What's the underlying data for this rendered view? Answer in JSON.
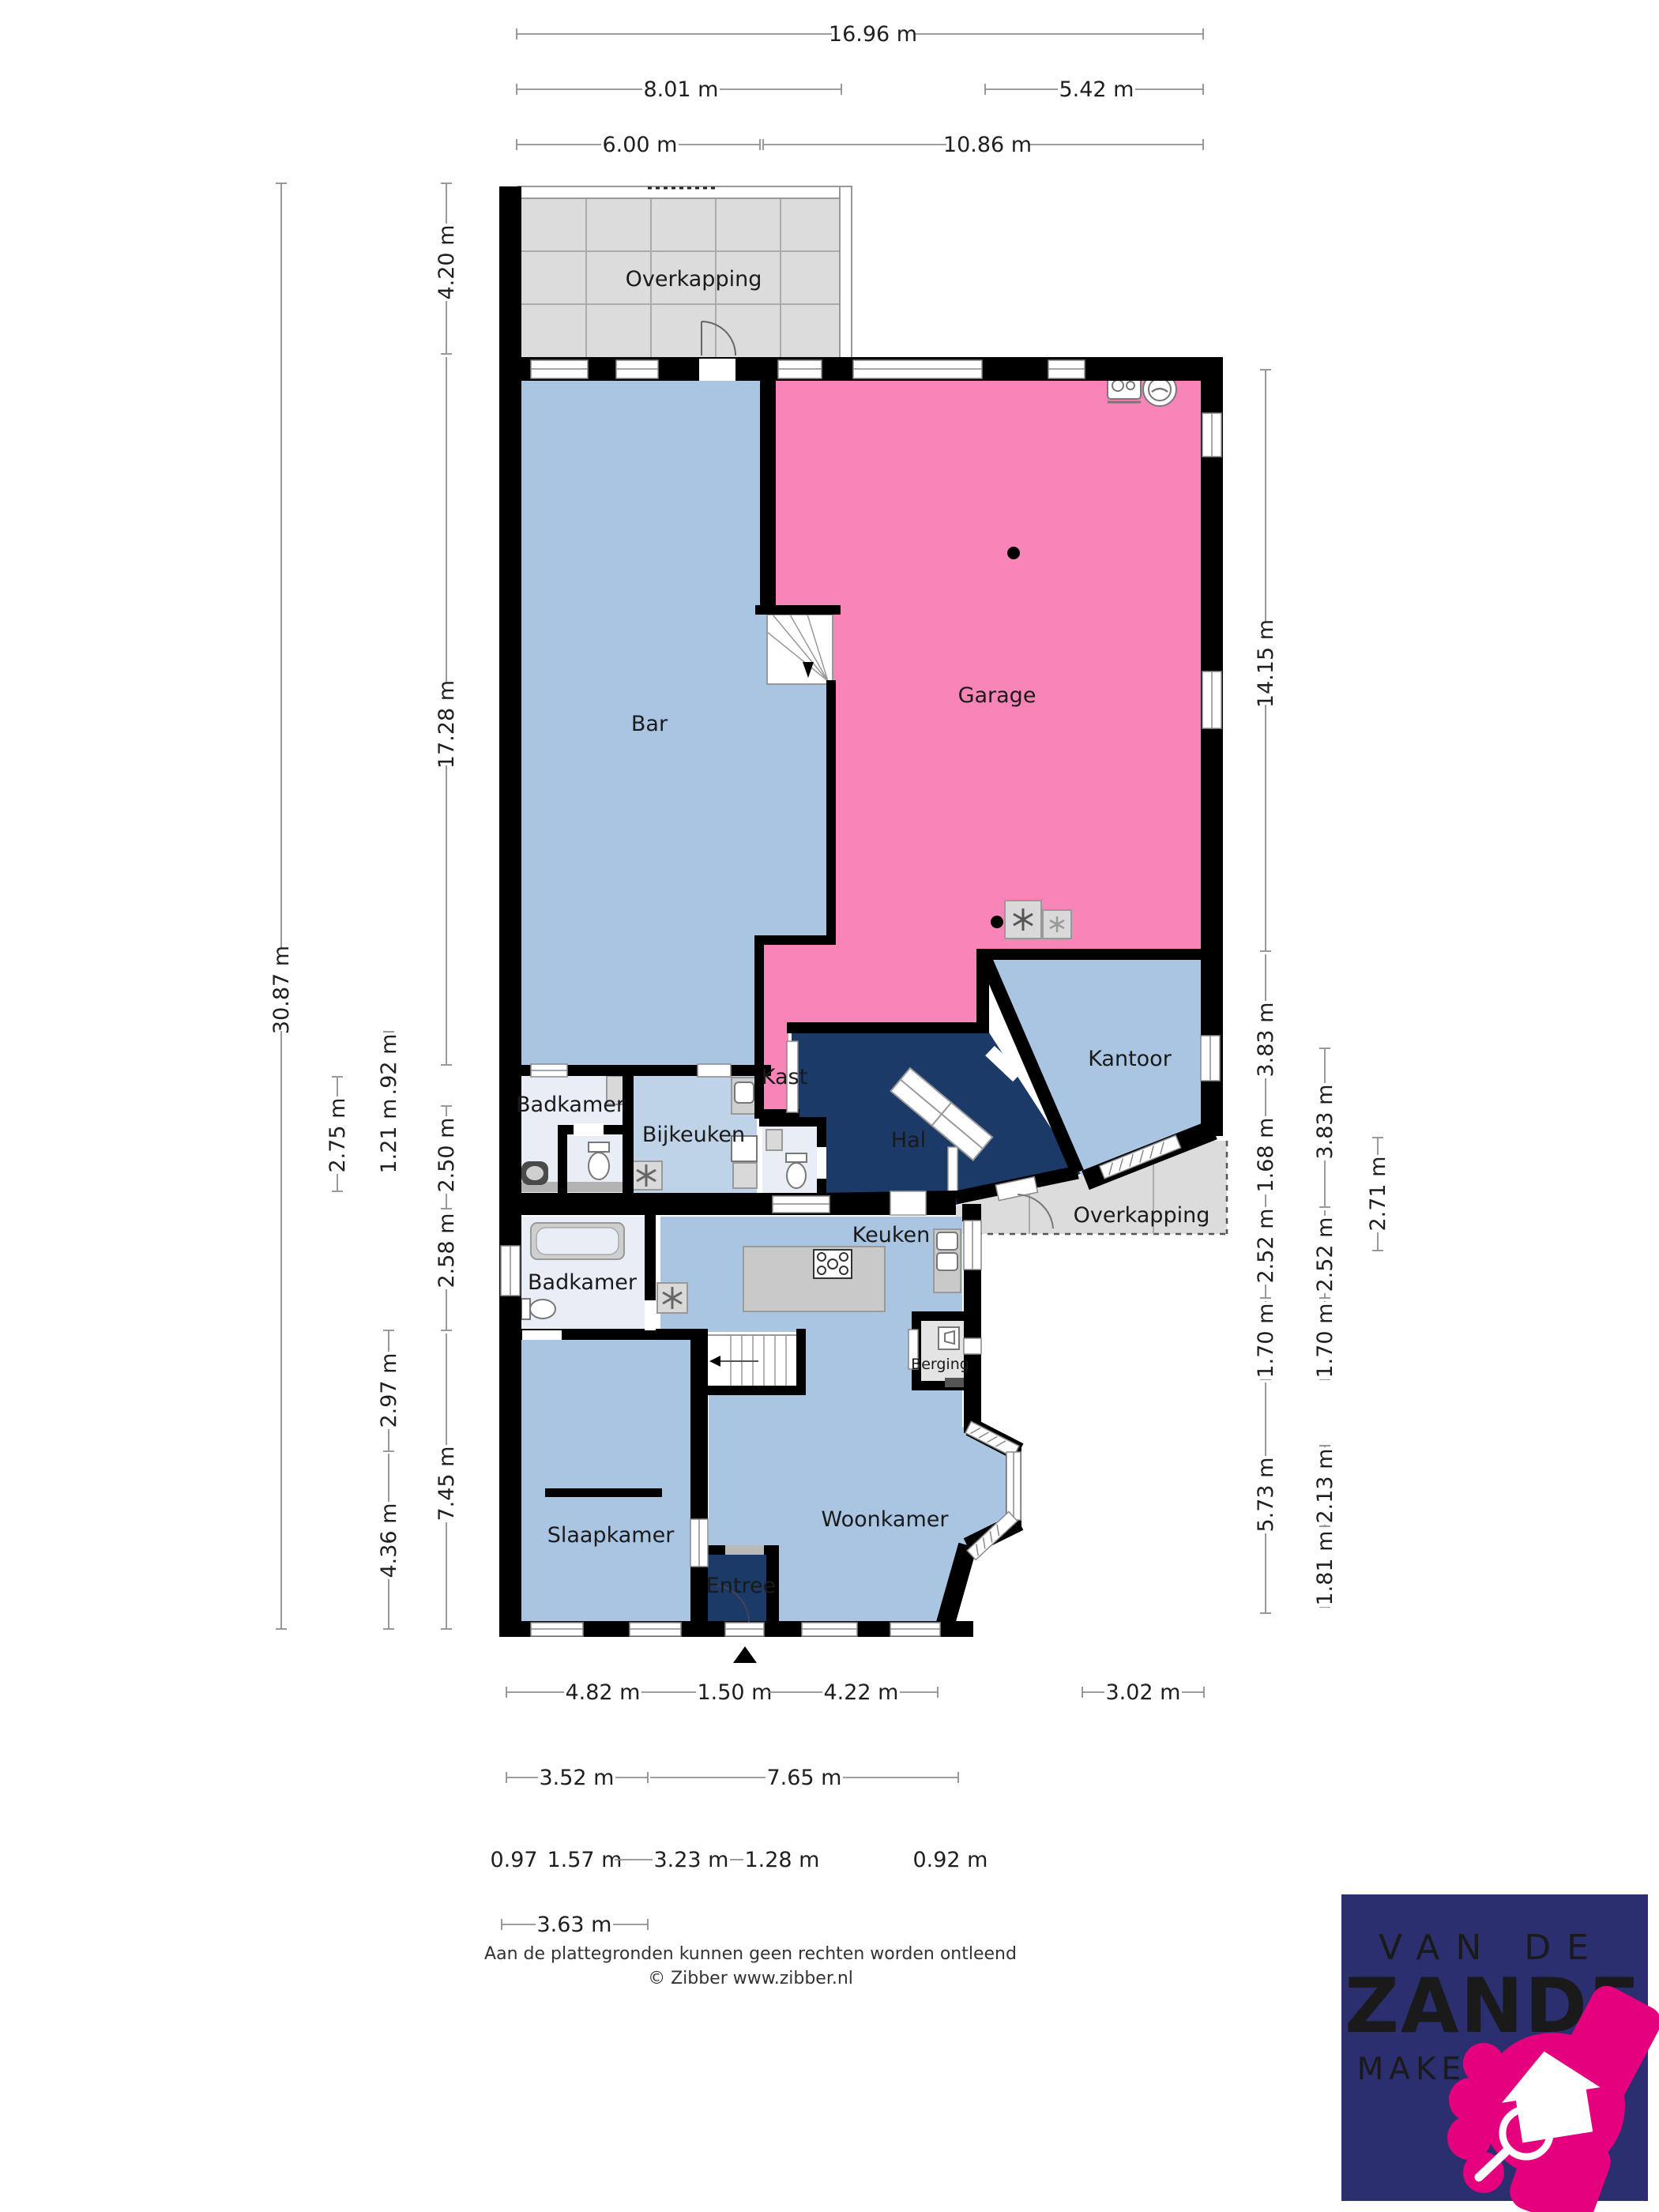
{
  "rooms": {
    "overkapping_top": "Overkapping",
    "bar": "Bar",
    "garage": "Garage",
    "kantoor": "Kantoor",
    "badkamer_boven": "Badkamer",
    "bijkeuken": "Bijkeuken",
    "kast": "Kast",
    "hal": "Hal",
    "overkapping_rechts": "Overkapping",
    "badkamer_beneden": "Badkamer",
    "keuken": "Keuken",
    "berging": "Berging",
    "slaapkamer": "Slaapkamer",
    "woonkamer": "Woonkamer",
    "entree": "Entree"
  },
  "dimensions": {
    "top": [
      "16.96 m",
      "8.01 m",
      "5.42 m",
      "6.00 m",
      "10.86 m"
    ],
    "left": [
      "30.87 m",
      "2.75 m",
      "1.92 m",
      "1.21 m",
      "2.97 m",
      "4.36 m",
      "4.20 m",
      "17.28 m",
      "2.50 m",
      "2.58 m",
      "7.45 m"
    ],
    "right": [
      "14.15 m",
      "3.83 m",
      "1.68 m",
      "2.52 m",
      "1.70 m",
      "5.73 m",
      "3.83 m",
      "2.52 m",
      "1.70 m",
      "2.13 m",
      "1.81 m",
      "2.71 m"
    ],
    "bottom": [
      "4.82 m",
      "1.50 m",
      "4.22 m",
      "3.02 m",
      "3.52 m",
      "7.65 m",
      "0.97 m",
      "1.57 m",
      "3.23 m",
      "1.28 m",
      "0.92 m",
      "3.63 m"
    ]
  },
  "footer": {
    "disclaimer": "Aan de plattegronden kunnen geen rechten worden ontleend",
    "copyright": "© Zibber www.zibber.nl"
  },
  "logo": {
    "line1": "VAN DE",
    "line2": "ZANDE",
    "line3": "MAKELAARDIJ"
  },
  "colors": {
    "floor_blue": "#a9c5e1",
    "floor_light": "#e9eef6",
    "floor_pink": "#f884b8",
    "floor_navy": "#1c3a67",
    "floor_gray": "#dcdcdc",
    "island_gray": "#c9c9c9",
    "wall": "#000000",
    "logo_bg": "#2b2e6f",
    "logo_pink": "#e5007d"
  }
}
